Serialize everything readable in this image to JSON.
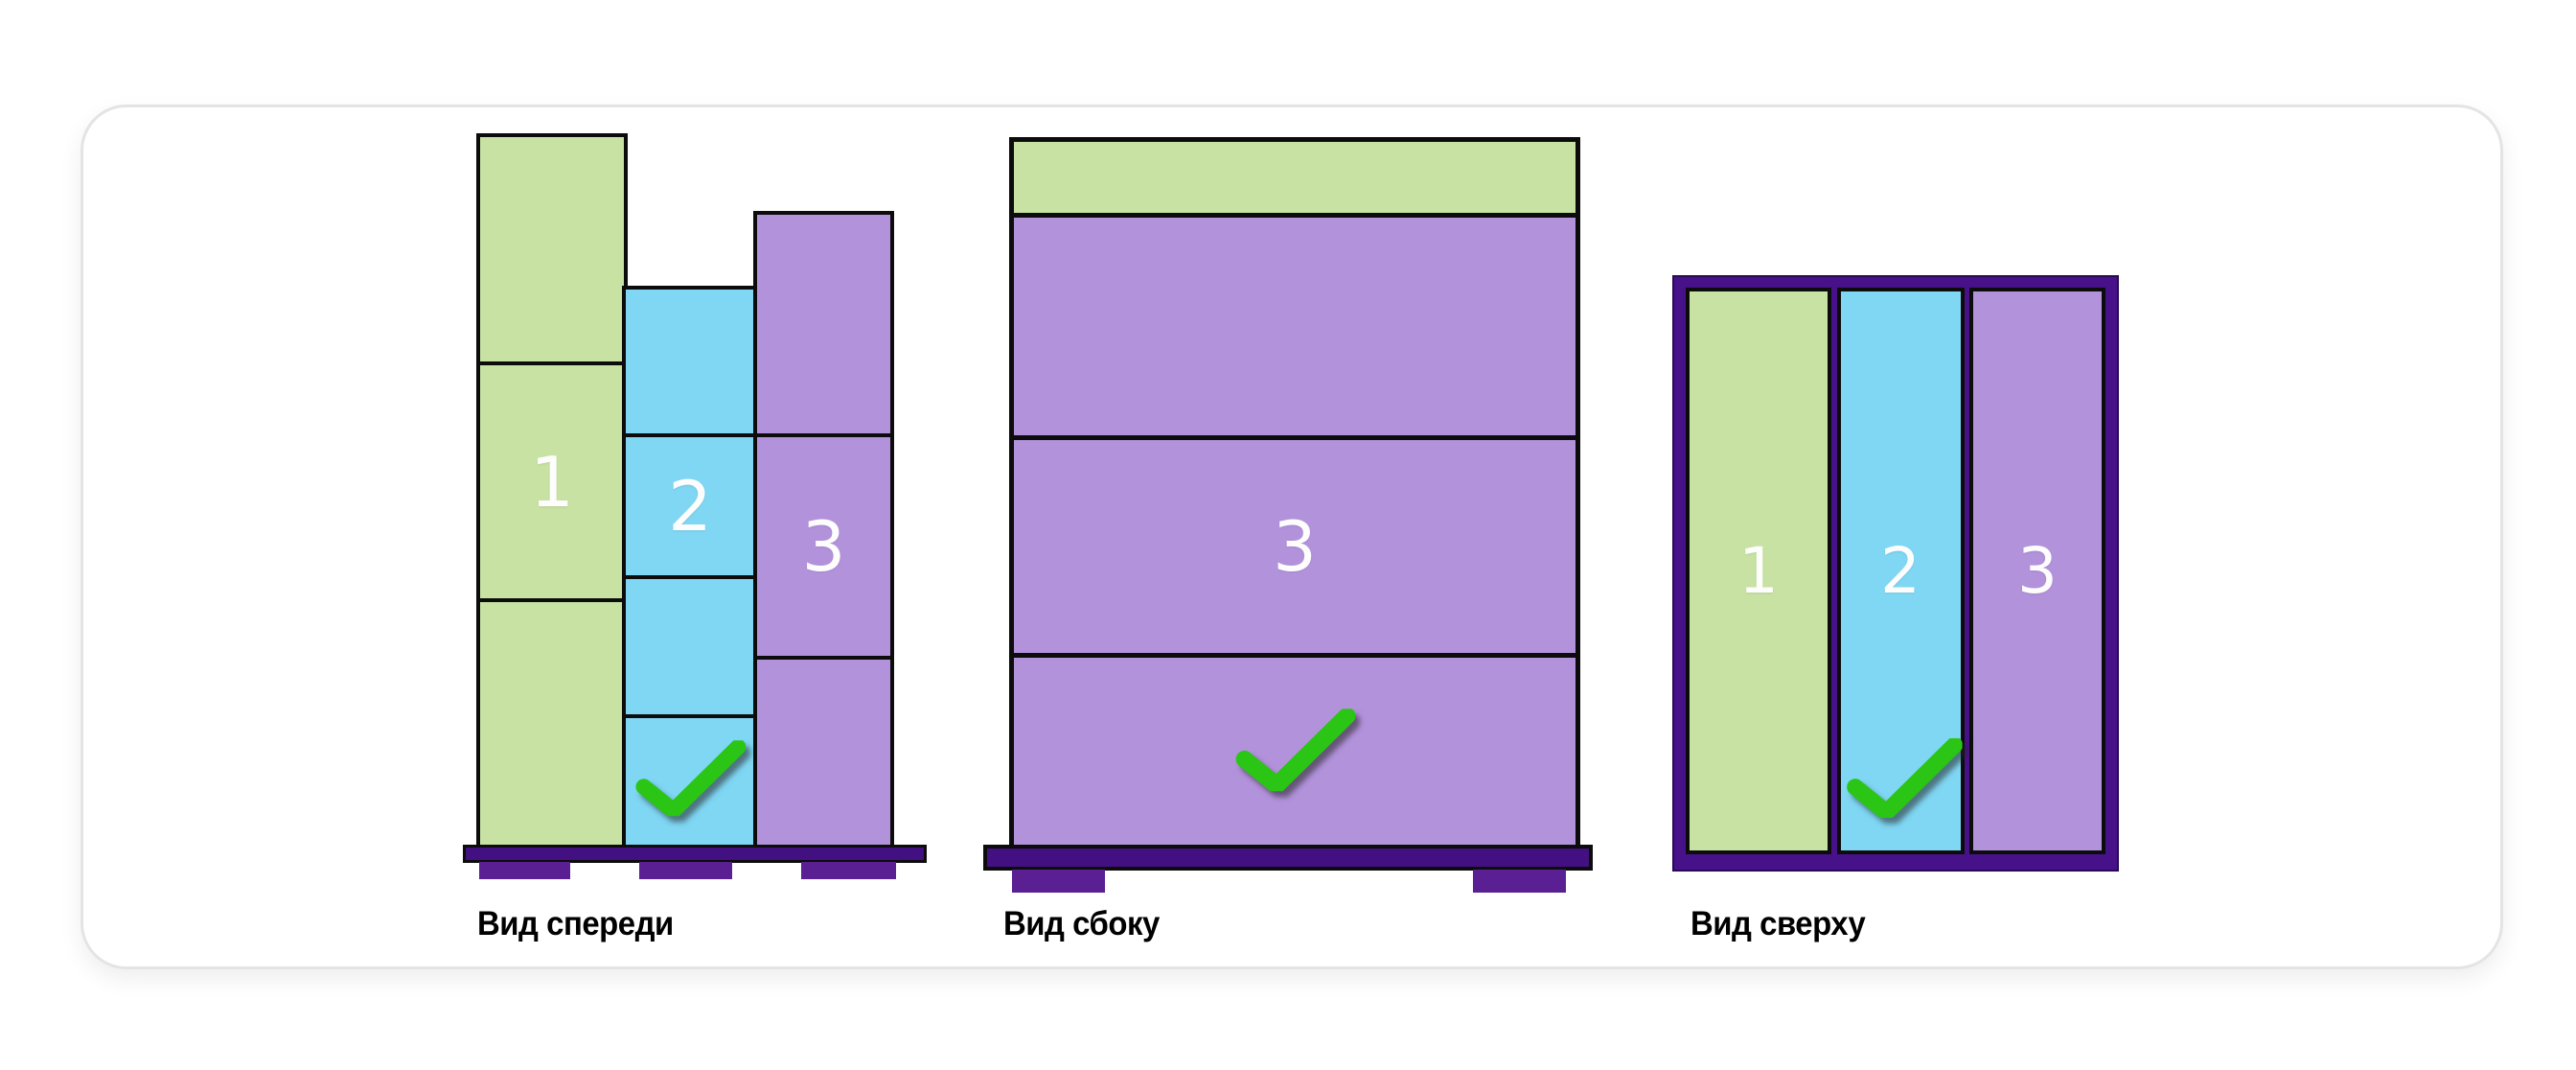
{
  "views": {
    "front": {
      "caption": "Вид спереди",
      "columns": [
        {
          "color": "green",
          "number": "1",
          "box_count": 3,
          "checked": false
        },
        {
          "color": "blue",
          "number": "2",
          "box_count": 4,
          "checked": true
        },
        {
          "color": "purple",
          "number": "3",
          "box_count": 3,
          "checked": false
        }
      ]
    },
    "side": {
      "caption": "Вид сбоку",
      "sections": [
        {
          "color": "green",
          "number": ""
        },
        {
          "color": "purple",
          "number": ""
        },
        {
          "color": "purple",
          "number": "3"
        },
        {
          "color": "purple",
          "number": "",
          "checked": true
        }
      ]
    },
    "top": {
      "caption": "Вид сверху",
      "strips": [
        {
          "color": "green",
          "number": "1",
          "checked": false
        },
        {
          "color": "blue",
          "number": "2",
          "checked": true
        },
        {
          "color": "purple",
          "number": "3",
          "checked": false
        }
      ]
    }
  },
  "colors": {
    "box_green": "#c8e2a3",
    "box_blue": "#7fd7f3",
    "box_purple": "#b392dc",
    "pallet_deck": "#431082",
    "pallet_foot": "#5a2093",
    "pallet_frame": "#471289",
    "outline": "#0c0c0c",
    "checkmark_green": "#2bc516",
    "card_border": "#e4e4e4",
    "caption_text": "#000000"
  }
}
